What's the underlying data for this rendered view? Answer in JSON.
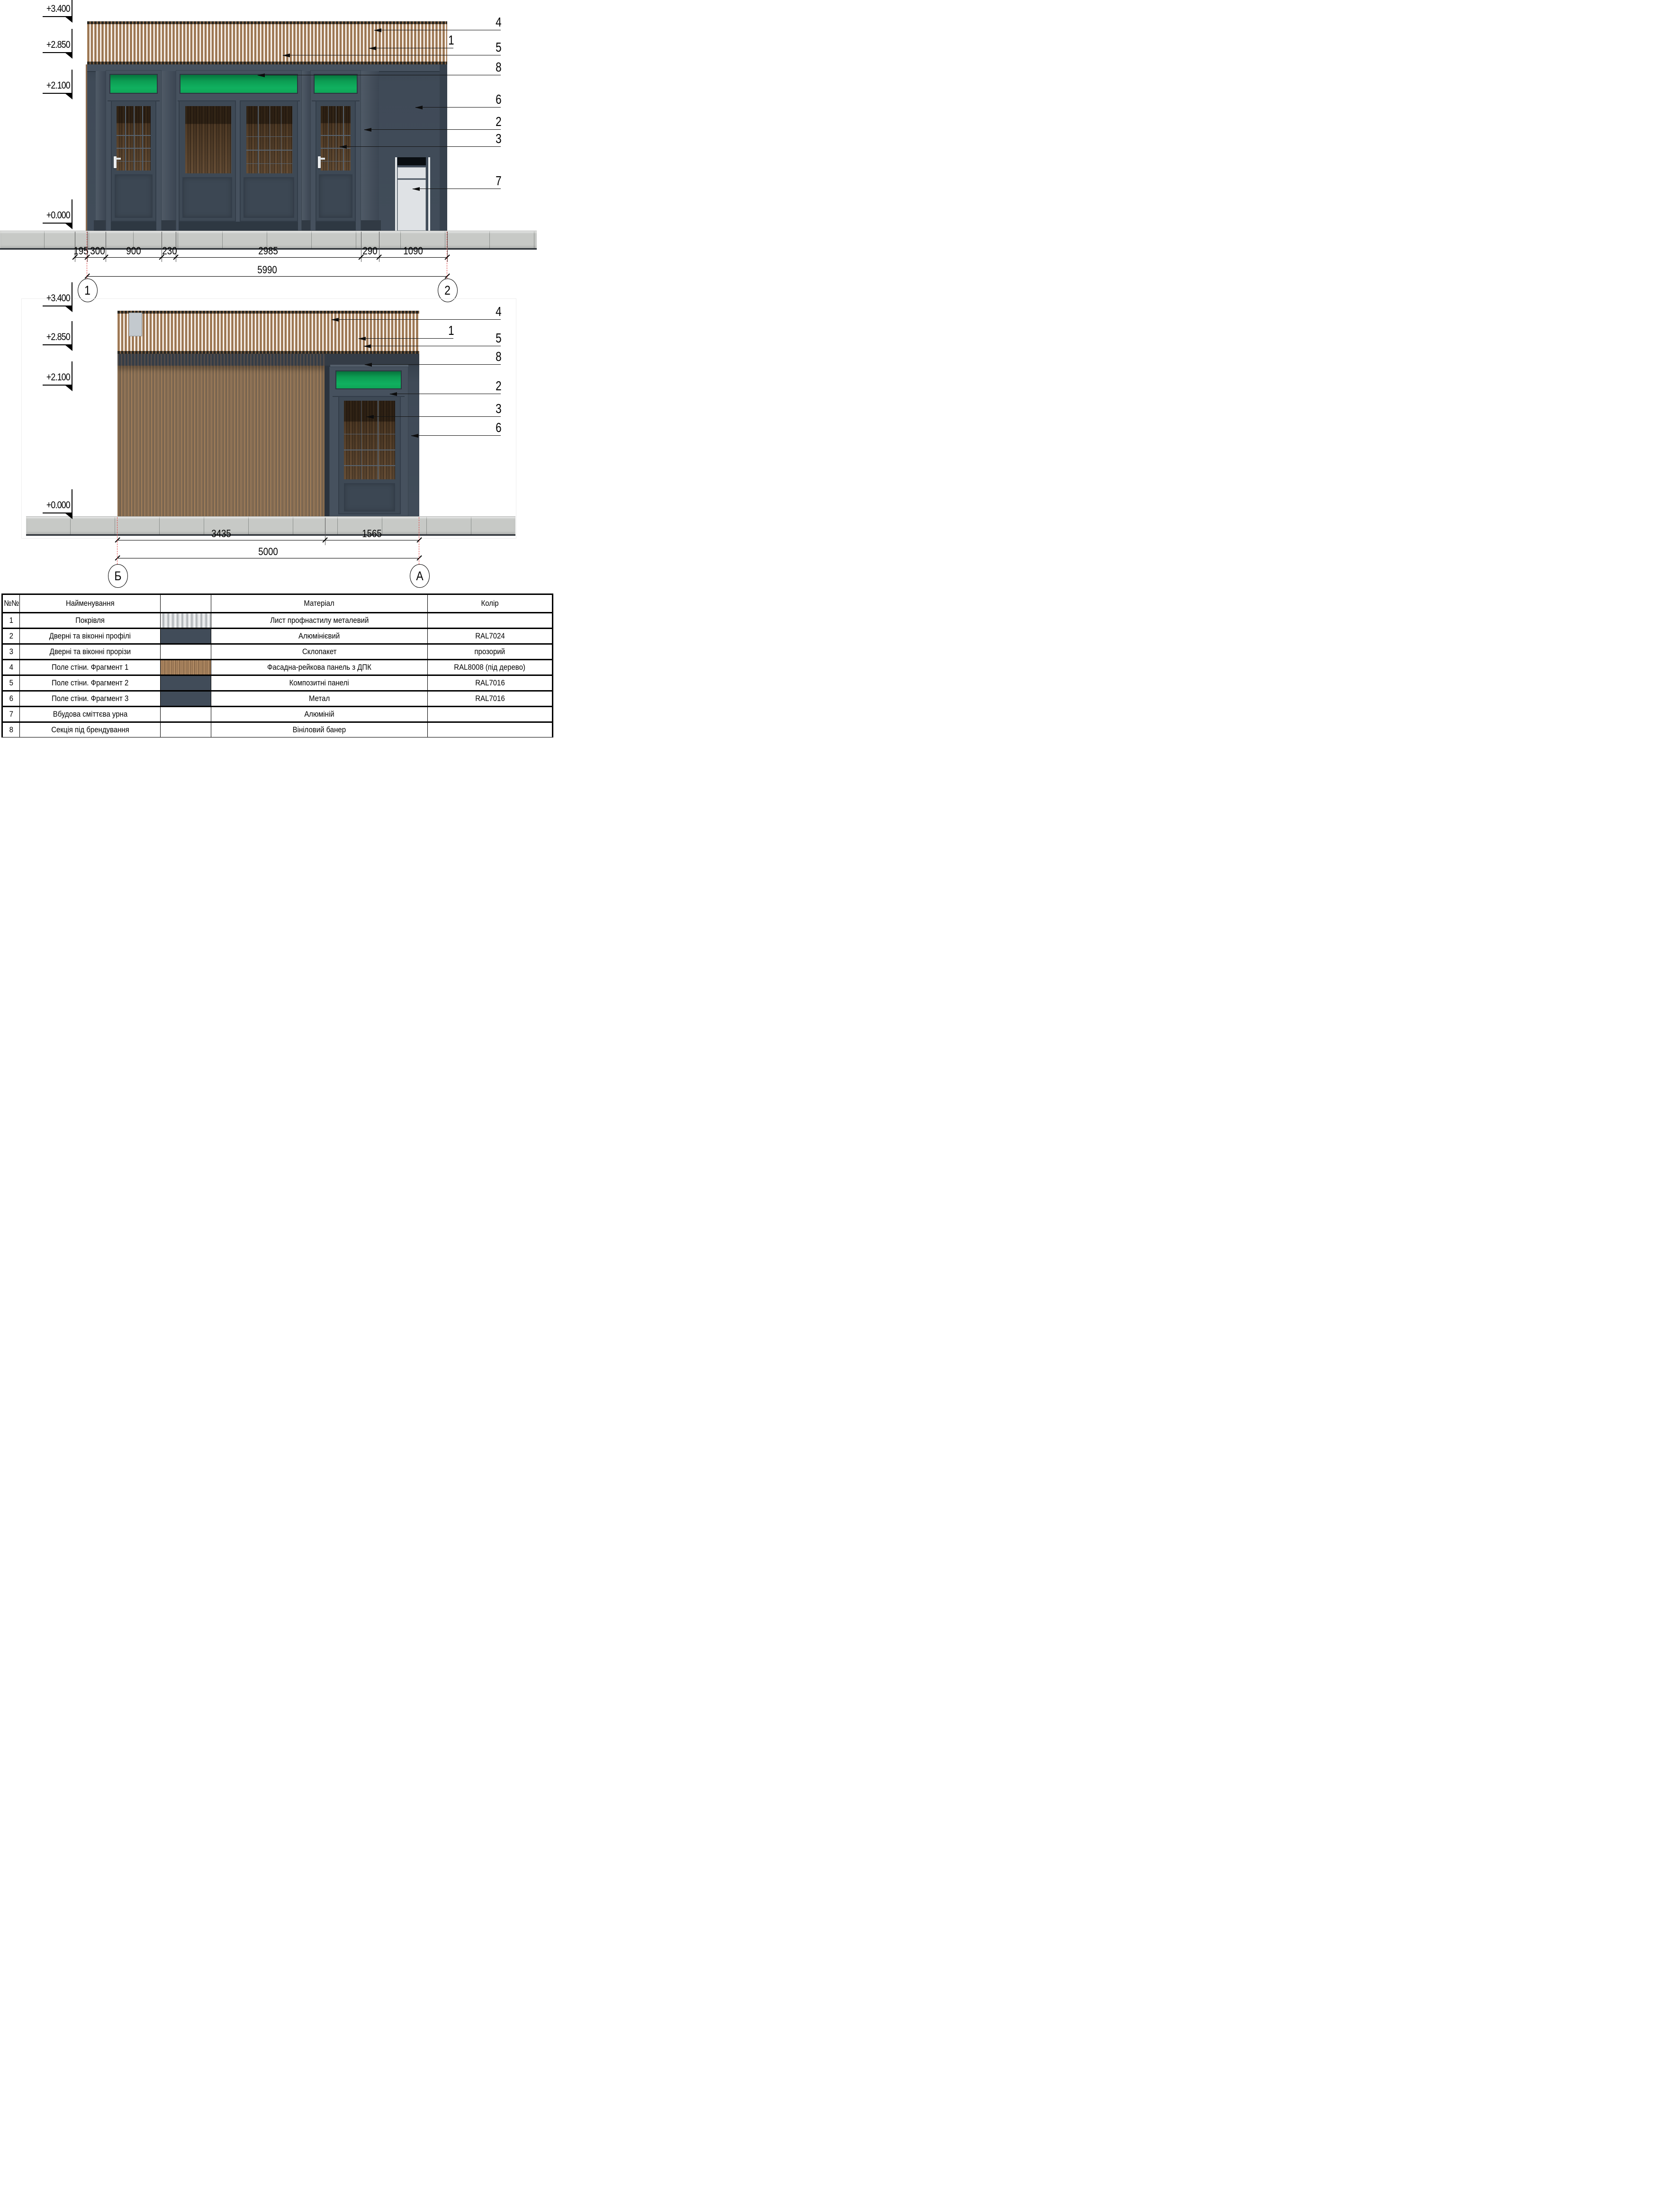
{
  "elev1": {
    "levels": [
      "+3.400",
      "+2.850",
      "+2.100",
      "+0.000"
    ],
    "callouts": {
      "c4": "4",
      "c1": "1",
      "c5": "5",
      "c8": "8",
      "c6": "6",
      "c2": "2",
      "c3": "3",
      "c7": "7"
    },
    "dims": {
      "d195": "195",
      "d300": "300",
      "d900": "900",
      "d230": "230",
      "d2985": "2985",
      "d290": "290",
      "d1090": "1090",
      "total": "5990"
    },
    "grids": {
      "left": "1",
      "right": "2"
    }
  },
  "elev2": {
    "levels": [
      "+3.400",
      "+2.850",
      "+2.100",
      "+0.000"
    ],
    "callouts": {
      "c4": "4",
      "c1": "1",
      "c5": "5",
      "c8": "8",
      "c2": "2",
      "c3": "3",
      "c6": "6"
    },
    "dims": {
      "d3435": "3435",
      "d1565": "1565",
      "total": "5000"
    },
    "grids": {
      "left": "Б",
      "right": "А"
    }
  },
  "table": {
    "headers": {
      "num": "№№",
      "name": "Найменування",
      "swatch": "",
      "material": "Матеріал",
      "color": "Колір"
    },
    "rows": [
      {
        "num": "1",
        "name": "Покрівля",
        "material": "Лист профнастилу металевий",
        "color": "",
        "swatch": "corrugated"
      },
      {
        "num": "2",
        "name": "Дверні та віконні профілі",
        "material": "Алюмінієвий",
        "color": "RAL7024",
        "swatch": "dark"
      },
      {
        "num": "3",
        "name": "Дверні та віконні прорізи",
        "material": "Склопакет",
        "color": "прозорий",
        "swatch": "none"
      },
      {
        "num": "4",
        "name": "Поле стіни. Фрагмент 1",
        "material": "Фасадна-рейкова панель з ДПК",
        "color": "RAL8008 (під дерево)",
        "swatch": "wood"
      },
      {
        "num": "5",
        "name": "Поле стіни. Фрагмент 2",
        "material": "Композитні панелі",
        "color": "RAL7016",
        "swatch": "dark"
      },
      {
        "num": "6",
        "name": "Поле стіни. Фрагмент 3",
        "material": "Метал",
        "color": "RAL7016",
        "swatch": "dark"
      },
      {
        "num": "7",
        "name": "Вбудова сміттєва урна",
        "material": "Алюміній",
        "color": "",
        "swatch": "none"
      },
      {
        "num": "8",
        "name": "Секція під брендування",
        "material": "Вініловий банер",
        "color": "",
        "swatch": "none"
      }
    ]
  },
  "colors": {
    "wall_dark": "#414c59",
    "wood_slat": "#a9835f",
    "banner_green": "#0fae5e",
    "grid_axis_red": "#e04545",
    "bin_white": "#dfe2e5",
    "sidewalk": "#c7c9c6"
  }
}
